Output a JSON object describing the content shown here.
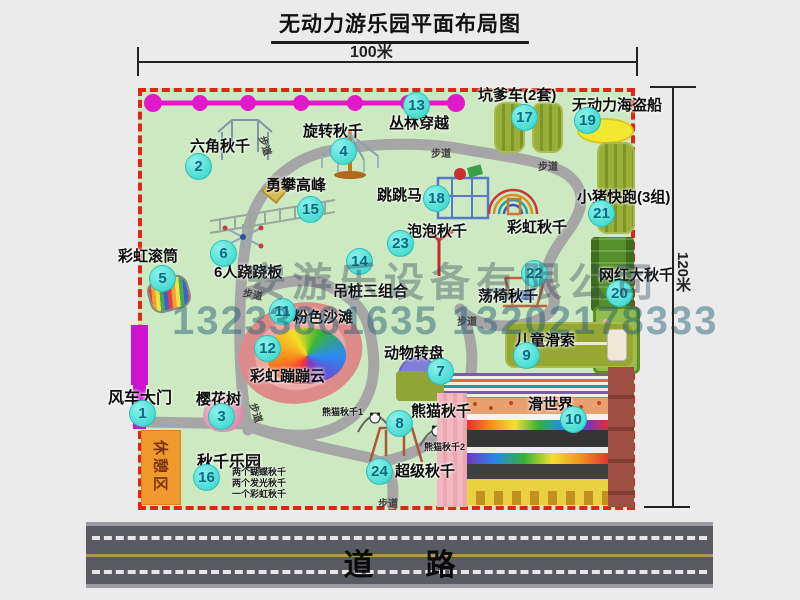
{
  "title": "无动力游乐园平面布局图",
  "dims": {
    "width": "100米",
    "height": "120米"
  },
  "road": {
    "label": "道路"
  },
  "watermark": {
    "company": "安游乐设备有限公司",
    "phones": "13233861635 13202178333"
  },
  "rest_area": "休憩区",
  "path_label": "步道",
  "rainbow_swing": "彩虹秋千",
  "panda_notes": {
    "p1": "熊猫秋千1",
    "p2": "熊猫秋千2"
  },
  "swing_park_notes": {
    "n1": "两个蝴蝶秋千",
    "n2": "两个发光秋千",
    "n3": "一个彩虹秋千"
  },
  "attractions": [
    {
      "num": "1",
      "name": "风车大门"
    },
    {
      "num": "2",
      "name": "六角秋千"
    },
    {
      "num": "3",
      "name": "樱花树"
    },
    {
      "num": "4",
      "name": "旋转秋千"
    },
    {
      "num": "5",
      "name": "彩虹滚筒"
    },
    {
      "num": "6",
      "name": "6人跷跷板"
    },
    {
      "num": "7",
      "name": "动物转盘"
    },
    {
      "num": "8",
      "name": "熊猫秋千"
    },
    {
      "num": "9",
      "name": "儿童滑索"
    },
    {
      "num": "10",
      "name": "滑世界"
    },
    {
      "num": "11",
      "name": "粉色沙滩"
    },
    {
      "num": "12",
      "name": "彩虹蹦蹦云"
    },
    {
      "num": "13",
      "name": "丛林穿越"
    },
    {
      "num": "14",
      "name": "吊桩三组合"
    },
    {
      "num": "15",
      "name": "勇攀高峰"
    },
    {
      "num": "16",
      "name": "秋千乐园"
    },
    {
      "num": "17",
      "name": "坑爹车(2套)"
    },
    {
      "num": "18",
      "name": "跳跳马"
    },
    {
      "num": "19",
      "name": "无动力海盗船"
    },
    {
      "num": "20",
      "name": "网红大秋千"
    },
    {
      "num": "21",
      "name": "小猪快跑(3组)"
    },
    {
      "num": "22",
      "name": "荡椅秋千"
    },
    {
      "num": "23",
      "name": "泡泡秋千"
    },
    {
      "num": "24",
      "name": "超级秋千"
    }
  ],
  "colors": {
    "map_green": "#cde9c2",
    "border_red": "#df2517",
    "magenta": "#e219ca",
    "circle_cyan": "#2ed3c8",
    "rest_orange": "#f09a2e",
    "road_gray": "#5a5a62"
  }
}
